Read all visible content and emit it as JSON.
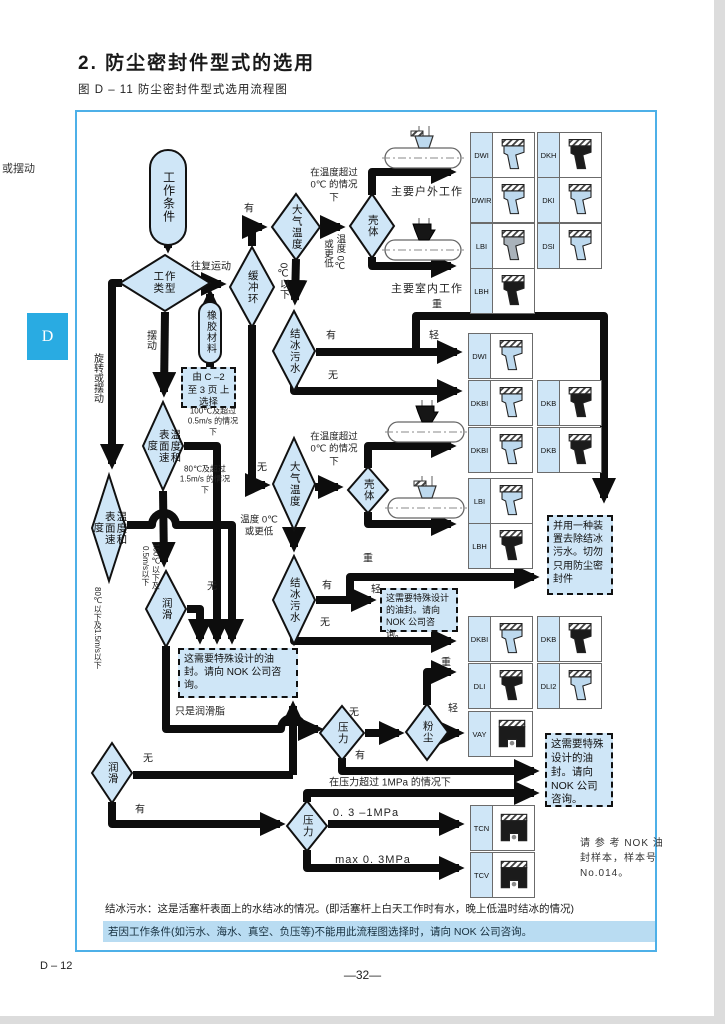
{
  "page": {
    "title": "2. 防尘密封件型式的选用",
    "subtitle": "图 D – 11 防尘密封件型式选用流程图",
    "margin_text": "或摆动",
    "tab_letter": "D",
    "footer_left": "D – 12",
    "footer_page": "—32—"
  },
  "nodes": {
    "work_condition": "工作条件",
    "work_type": "工作类型",
    "rubber_material": "橡胶材料",
    "buffer_ring": "缓冲环",
    "atm_temp": "大气温度",
    "housing": "壳体",
    "icy_water": "结冰污水",
    "temp_surface_speed": "温度和表面速度",
    "lubrication": "润滑",
    "pressure": "压力",
    "dust": "粉尘"
  },
  "boxes": {
    "select_from_page": "由 C –2 至 3 页 上选择",
    "special_design": "这需要特殊设计的油封。请向 NOK 公司咨询。",
    "remove_device": "并用一种装置去除结冰污水。切勿只用防尘密封件",
    "nok_reference": "请 参 考 NOK 油封样本，样本号 No.014。"
  },
  "labels": {
    "reciprocating": "往复运动",
    "swing": "摆动",
    "rotate_or_swing": "旋转或摆动",
    "yes": "有",
    "no": "无",
    "heavy": "重",
    "light": "轻",
    "below_0c": "0℃以下",
    "above_0c": "在温度超过 0℃ 的情况下",
    "temp_0c_or_lower": "温度 0℃ 或更低",
    "cond_100c": "100℃及超过 0.5m/s 的情况下",
    "cond_80c": "80℃及超过 1.5m/s 的情况下",
    "below_100c": "100℃以下及0.5m/s以下",
    "below_80c": "80℃以下及1.5m/s以下",
    "grease_only": "只是润滑脂",
    "outdoor": "主要户外工作",
    "indoor": "主要室内工作",
    "over_1mpa": "在压力超过 1MPa 的情况下",
    "mpa_03_1": "0. 3 –1MPa",
    "mpa_max_03": "max 0. 3MPa"
  },
  "seals": {
    "dwi": "DWI",
    "dwir": "DWIR",
    "dkh": "DKH",
    "dki": "DKI",
    "lbi": "LBI",
    "lbh": "LBH",
    "dsi": "DSI",
    "dkbi": "DKBI",
    "dkb": "DKB",
    "dli": "DLI",
    "dli2": "DLI2",
    "vay": "VAY",
    "tcn": "TCN",
    "tcv": "TCV"
  },
  "notes": {
    "icy_note": "结冰污水：这是活塞杆表面上的水结冰的情况。(即活塞杆上白天工作时有水，晚上低温时结冰的情况)",
    "consult_note": "若因工作条件(如污水、海水、真空、负压等)不能用此流程图选择时，请向 NOK 公司咨询。"
  },
  "colors": {
    "node_fill": "#cfe6f7",
    "accent_blue": "#29abe2",
    "highlight": "#b9dcf2",
    "seal_light": "#bdd9ee",
    "seal_dark": "#1b1b1b"
  }
}
